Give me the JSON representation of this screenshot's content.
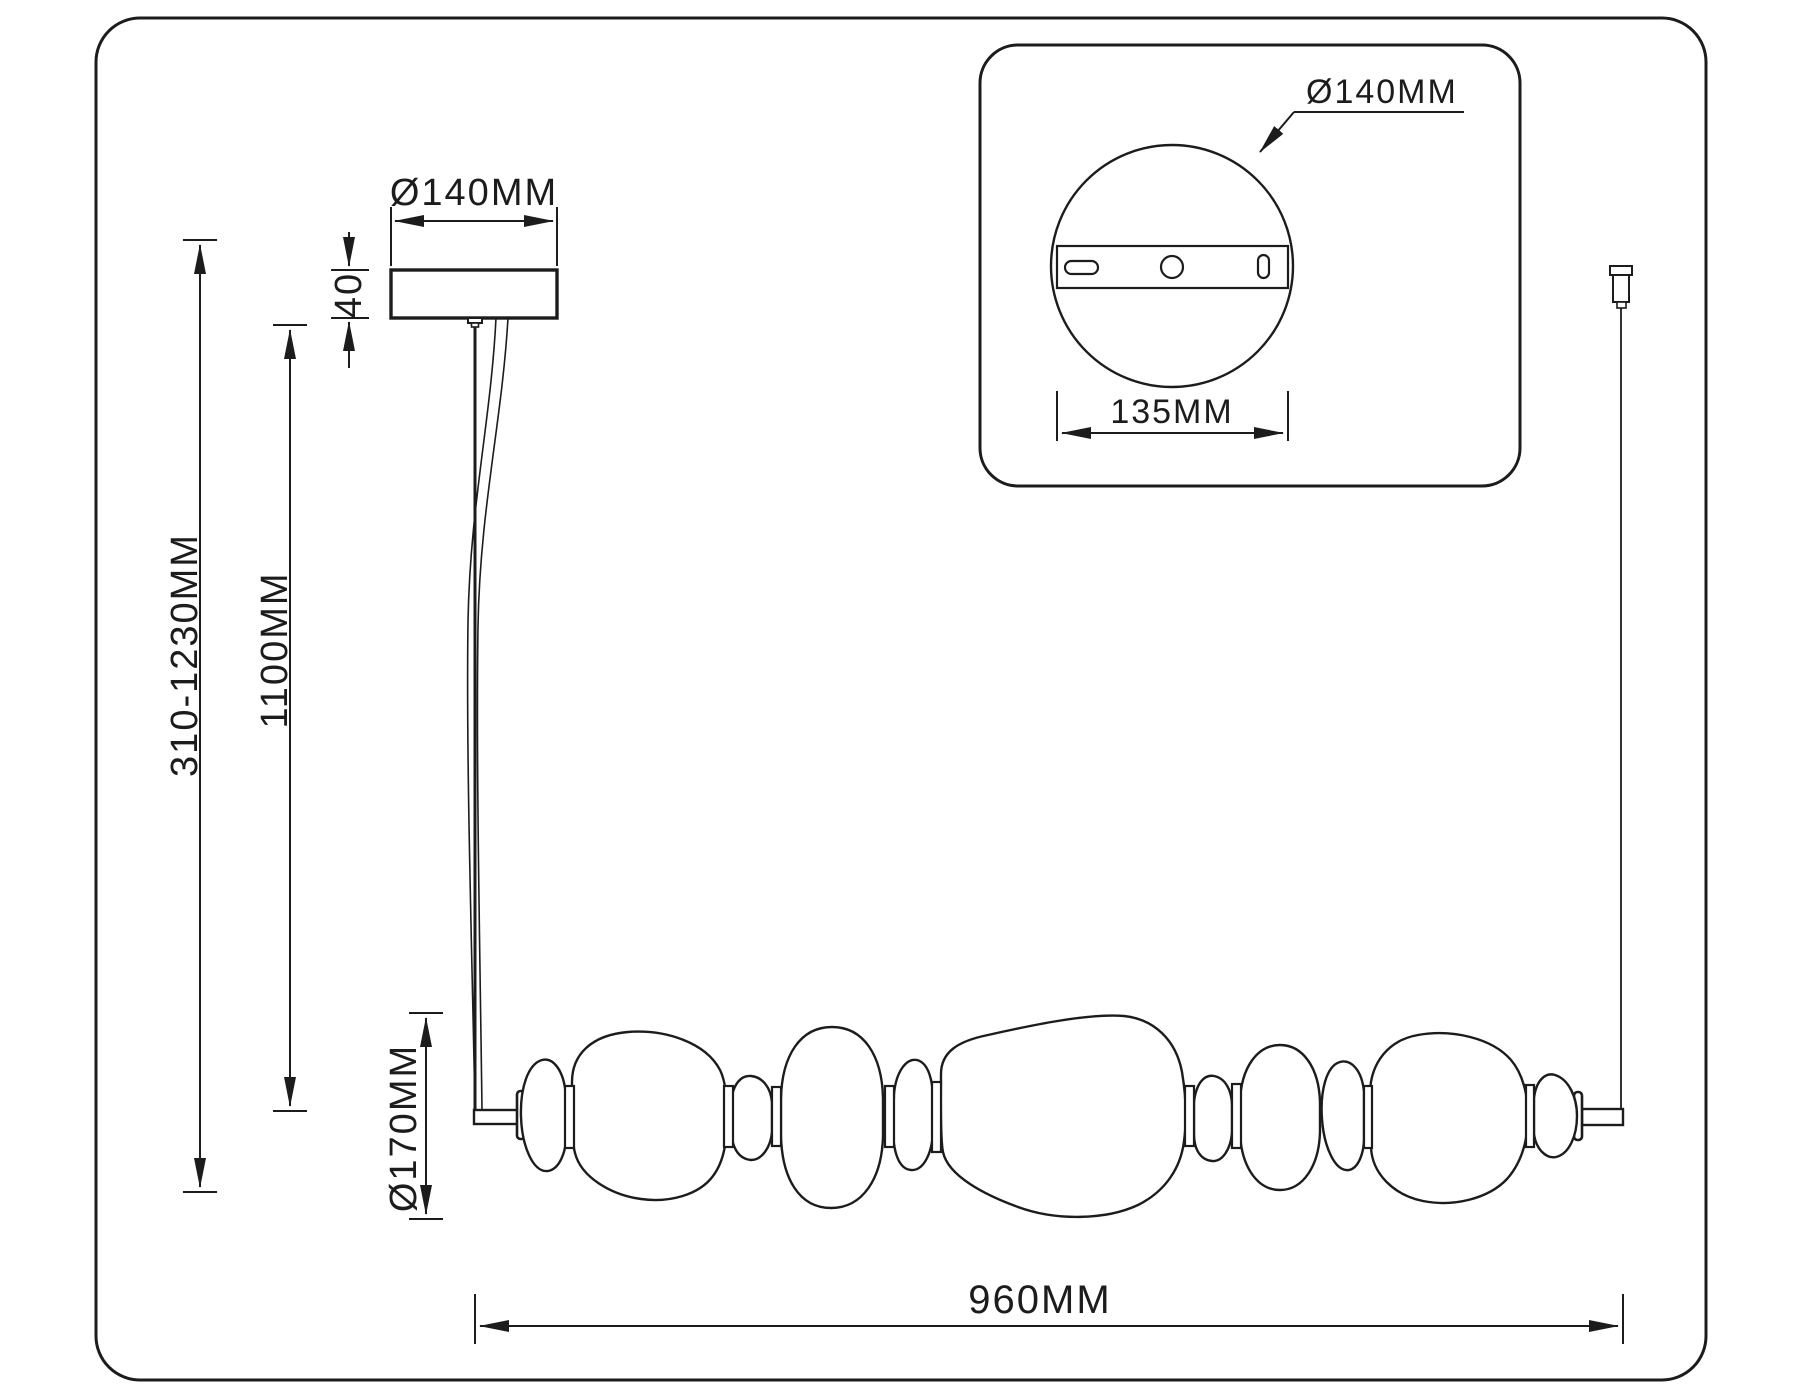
{
  "drawing": {
    "type": "pendant-lamp-technical-dimension-drawing",
    "background": "#ffffff",
    "line_color": "#1c1c1c",
    "labels": {
      "canopy_diameter": "Ø140MM",
      "canopy_height": "40",
      "total_height_range": "310-1230MM",
      "rod_drop": "1100MM",
      "shade_diameter": "Ø170MM",
      "fixture_width": "960MM",
      "inset_canopy_diameter": "Ø140MM",
      "inset_plate_width": "135MM"
    }
  }
}
